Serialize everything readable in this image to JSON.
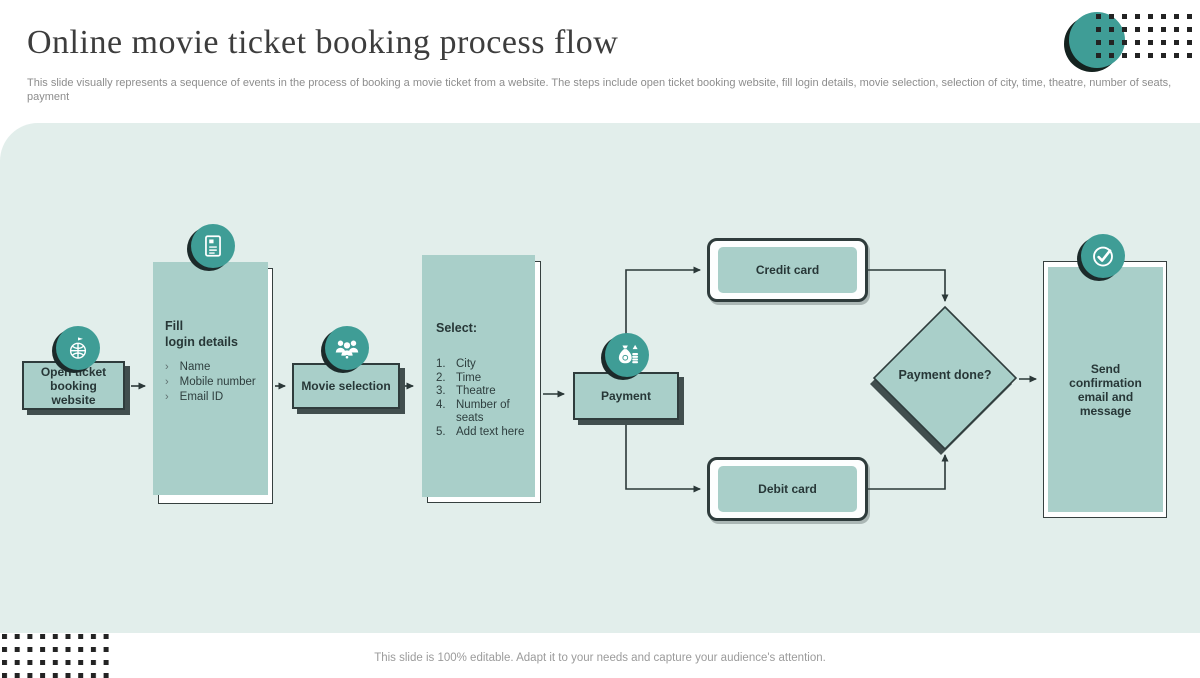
{
  "header": {
    "title": "Online movie ticket booking process flow",
    "subtitle": "This slide visually represents a sequence of events in the process of booking a movie ticket from a website. The steps include open ticket booking website, fill login details, movie selection, selection of city, time, theatre, number of seats, payment"
  },
  "flow": {
    "open_website": {
      "label": "Open ticket booking website",
      "icon": "globe-flag-icon"
    },
    "fill_login": {
      "title_line1": "Fill",
      "title_line2": "login details",
      "items": [
        "Name",
        "Mobile number",
        "Email ID"
      ],
      "icon": "registration-form-icon"
    },
    "movie_selection": {
      "label": "Movie selection",
      "icon": "audience-group-icon"
    },
    "select_options": {
      "title": "Select:",
      "items": [
        "City",
        "Time",
        "Theatre",
        "Number of seats",
        "Add text here"
      ]
    },
    "payment": {
      "label": "Payment",
      "icon": "money-bag-icon"
    },
    "credit_card": {
      "label": "Credit card"
    },
    "debit_card": {
      "label": "Debit card"
    },
    "decision": {
      "label": "Payment done?"
    },
    "confirmation": {
      "label": "Send confirmation email and message",
      "icon": "check-circle-icon"
    }
  },
  "footer": {
    "note": "This slide is 100% editable. Adapt it to your needs and capture your audience's attention."
  },
  "colors": {
    "accent_teal": "#3f9d96",
    "box_fill": "#a9cfc9",
    "canvas_bg": "#e2eeeb",
    "dark_outline": "#2f3c3c"
  }
}
